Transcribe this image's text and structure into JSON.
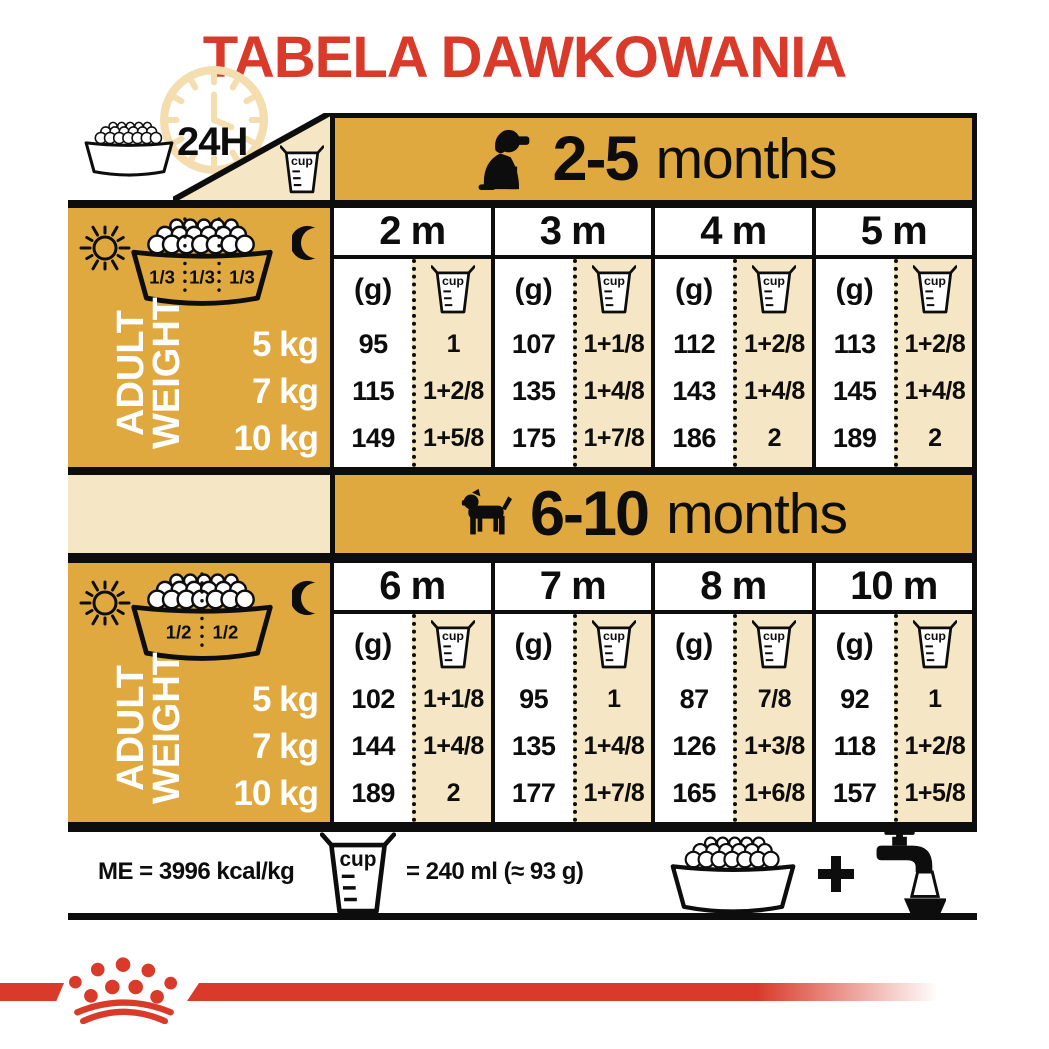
{
  "title": "TABELA DAWKOWANIA",
  "colors": {
    "red": "#D93A2A",
    "gold": "#DFA93F",
    "beige": "#F5E7C5",
    "line": "#0D0D0D"
  },
  "header": {
    "daily_label": "24H",
    "cup_label": "cup"
  },
  "sections": [
    {
      "age_bold": "2-5",
      "age_rest": "months",
      "bowl_fractions": [
        "1/3",
        "1/3",
        "1/3"
      ],
      "adult_weight_label": [
        "ADULT",
        "WEIGHT"
      ],
      "weights": [
        "5 kg",
        "7 kg",
        "10 kg"
      ],
      "unit_g": "(g)",
      "unit_cup": "cup",
      "months": [
        {
          "label": "2 m",
          "grams": [
            "95",
            "115",
            "149"
          ],
          "cups": [
            "1",
            "1+2/8",
            "1+5/8"
          ]
        },
        {
          "label": "3 m",
          "grams": [
            "107",
            "135",
            "175"
          ],
          "cups": [
            "1+1/8",
            "1+4/8",
            "1+7/8"
          ]
        },
        {
          "label": "4 m",
          "grams": [
            "112",
            "143",
            "186"
          ],
          "cups": [
            "1+2/8",
            "1+4/8",
            "2"
          ]
        },
        {
          "label": "5 m",
          "grams": [
            "113",
            "145",
            "189"
          ],
          "cups": [
            "1+2/8",
            "1+4/8",
            "2"
          ]
        }
      ]
    },
    {
      "age_bold": "6-10",
      "age_rest": "months",
      "bowl_fractions": [
        "1/2",
        "1/2"
      ],
      "adult_weight_label": [
        "ADULT",
        "WEIGHT"
      ],
      "weights": [
        "5 kg",
        "7 kg",
        "10 kg"
      ],
      "unit_g": "(g)",
      "unit_cup": "cup",
      "months": [
        {
          "label": "6 m",
          "grams": [
            "102",
            "144",
            "189"
          ],
          "cups": [
            "1+1/8",
            "1+4/8",
            "2"
          ]
        },
        {
          "label": "7 m",
          "grams": [
            "95",
            "135",
            "177"
          ],
          "cups": [
            "1",
            "1+4/8",
            "1+7/8"
          ]
        },
        {
          "label": "8 m",
          "grams": [
            "87",
            "126",
            "165"
          ],
          "cups": [
            "7/8",
            "1+3/8",
            "1+6/8"
          ]
        },
        {
          "label": "10 m",
          "grams": [
            "92",
            "118",
            "157"
          ],
          "cups": [
            "1",
            "1+2/8",
            "1+5/8"
          ]
        }
      ]
    }
  ],
  "footer": {
    "me_label": "ME = 3996 kcal/kg",
    "cup_equiv": "= 240 ml (≈ 93 g)",
    "cup_label": "cup",
    "plus": "+"
  }
}
